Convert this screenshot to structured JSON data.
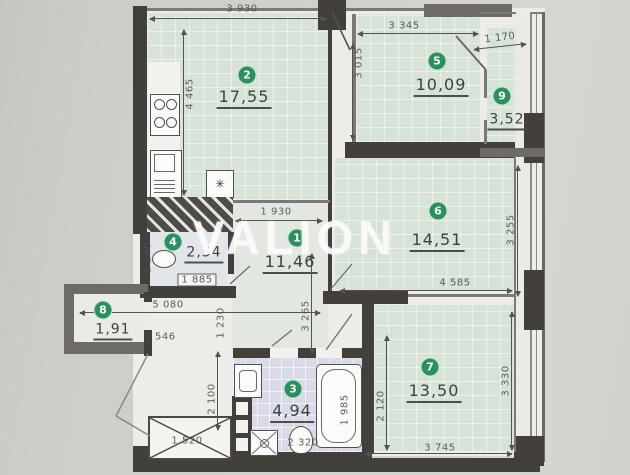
{
  "watermark": "VALION",
  "rooms": {
    "r1": {
      "num": "1",
      "area": "11,46"
    },
    "r2": {
      "num": "2",
      "area": "17,55"
    },
    "r3": {
      "num": "3",
      "area": "4,94"
    },
    "r4": {
      "num": "4",
      "area": "2,34"
    },
    "r5": {
      "num": "5",
      "area": "10,09"
    },
    "r6": {
      "num": "6",
      "area": "14,51"
    },
    "r7": {
      "num": "7",
      "area": "13,50"
    },
    "r8": {
      "num": "8",
      "area": "1,91"
    },
    "r9": {
      "num": "9",
      "area": "3,52"
    }
  },
  "dims": {
    "top_room2": "3 930",
    "top_room5": "3 345",
    "top_balcony": "1 170",
    "room2_depth": "4 465",
    "room5_depth": "3 015",
    "hall_top": "1 930",
    "wc_depth": "1 240",
    "wc_width": "1 885",
    "hall_width": "5 080",
    "hall_drop": "1 230",
    "balcony8_pass": "1 546",
    "corridor_depth": "3 265",
    "room6_width": "4 585",
    "room6_depth": "3 255",
    "shaft_width": "1 520",
    "lobby_depth": "2 100",
    "bath_width": "2 320",
    "bath_depth": "1 985",
    "room7_entry_depth": "2 120",
    "room7_width": "3 745",
    "room7_depth": "3 330"
  },
  "icons": {
    "vent_star": "✳"
  },
  "colors": {
    "room_fill": "#d7e3d6",
    "wall": "#43403c",
    "badge_green": "#27915d",
    "bath_fill": "#d9dae8"
  }
}
